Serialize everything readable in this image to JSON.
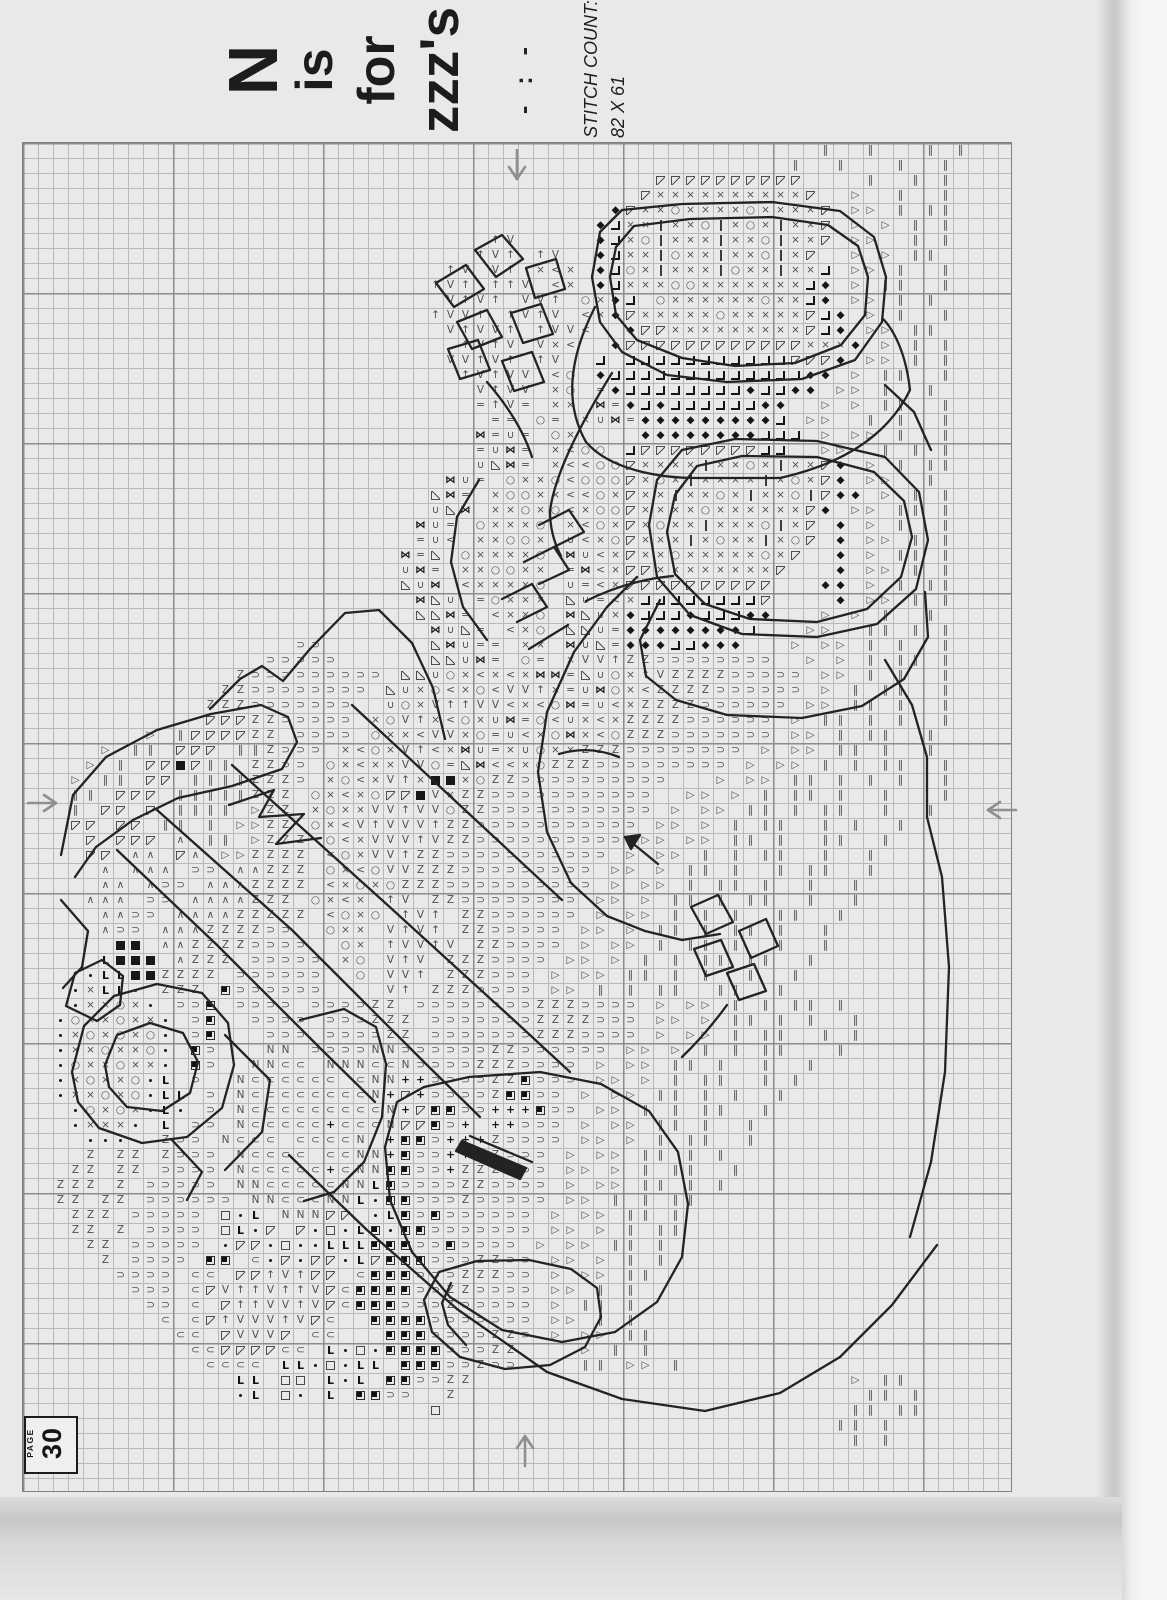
{
  "header": {
    "title_lines": [
      "N",
      "is",
      "for",
      "zzz's"
    ],
    "divider": "- : -",
    "stitch_count_label": "STITCH COUNT:",
    "stitch_count_value": "82 X 61"
  },
  "page_badge": {
    "label": "PAGE",
    "number": "30"
  },
  "grid": {
    "cols": 66,
    "rows": 90,
    "cell_px": 15,
    "major_every": 10
  },
  "arrows": [
    "center-arrow-top-down",
    "center-arrow-left-right",
    "center-arrow-right-left",
    "center-arrow-bottom-up"
  ],
  "colors": {
    "paper": "#e9e9e7",
    "grid_minor": "#b9b9b7",
    "grid_major": "#8c8c8a",
    "symbol": "#4e4e4c",
    "symbol_dark": "#161616",
    "backstitch": "#232321",
    "arrow": "#8f8f8d"
  },
  "legend": {
    "glyphs": {
      "x": "×",
      "o": "○",
      "d": "◆",
      "t": "▷",
      "I": "‖",
      "z": "Z",
      "D": "⊃",
      "A": "∧",
      "^": "↑",
      "V": "V",
      "M": "⋈",
      "U": "∪",
      "<": "<",
      "L": "◁",
      "=": "=",
      "C": "⊂",
      "N": "N",
      "G": "L",
      "+": "+"
    },
    "classes": {
      "x": "g",
      "o": "g",
      "t": "g",
      "I": "g",
      "z": "g",
      "D": "g",
      "A": "g",
      "^": "g",
      "V": "g",
      "U": "g",
      "<": "g",
      "L": "g",
      "=": "g",
      "C": "g",
      "N": "g",
      "d": "k",
      "M": "k",
      "+": "k",
      "G": "kb",
      "B": "B",
      "Q": "Q",
      "q": "q",
      ".": "dot",
      "|": "bar",
      "v": "v",
      "a": "a",
      "j": "j"
    },
    "meaning": {
      "x": "cross stitch ×",
      "o": "circle stitch",
      "d": "filled diamond",
      "t": "open right triangle",
      "I": "double bar",
      "z": "letter Z stitch",
      "D": "open U rotated",
      "A": "caret",
      "^": "up arrow",
      "V": "letter V",
      "M": "bowtie",
      "U": "cup",
      "<": "less-than",
      "L": "open left triangle",
      "=": "equals",
      "C": "open C",
      "N": "letter N",
      "G": "bold L",
      "+": "plus",
      "B": "solid square",
      "Q": "square with corner dot",
      "q": "open square",
      ".": "small dot",
      "|": "thin bar",
      "v": "upper-left half square",
      "a": "lower-left half square",
      "j": "corner bracket"
    }
  },
  "grid_rows": [
    "                                                     I  I   I I",
    "                                                   I  I   I  I",
    "                                          vvvvvvvvvv    I  I I",
    "                                         vxxxxxxxxxxv  t  I  I",
    "                                       dvxxoxxxxoxxxxv tt I II",
    "                                      djxx|xxo|xox|xxv t t I I",
    "                               ^V     djxo|xxx|xxo|xxv tt  I I",
    "                              ^V^ ^V  djxx|oxx|xxo|xv  t t II ",
    "                            ^V V^ x<x djox|xxx|oxx|xxj tt I  I",
    "                           ^V^ ^^V <x djxxxooxxxxxxxjd t II  I",
    "                            V^V^ VV^ oxdj oxxxxxxoxxjd tt I I ",
    "                           ^VV^ ^V^V <xdvxxxxxoxxxxxvjd t I  I",
    "                            V^VV^ ^VV<  dvvxxxxxxxxxvjd tt II ",
    "                             ^V^V Vx<  dvvvvvvvvvvvvxxxd t I I",
    "                            VV^V^ ^V  j jjjjjjjjjjjvvvd tt I I",
    "                             ^V^VV <o djjjjjjjjjjjjjdd t II  I",
    "                              V^VV xo =djjjjjjjjdjjdd tt I  I ",
    "                              =^V= xx M=djdjjjjjjdd  t t II  I",
    "                               == o= xUM=dddddddddj tt  I I  I",
    "                              M=U= ox    ddddddddjjj t tt I  I",
    "                              =UM= x<oo jvvvvvvvvjj  tt  I I I",
    "                              UaM= x<<oovxxxx|xxox|xxvd t I II",
    "                            MU= oxxo<ooovxox|xxxx|xoxvd tt  I ",
    "                           aM= xooxx<<oxvxx|xxox|xxo|vdd t I I",
    "                           UaM xxoxo<xoovxxxxoxxxxxxvd tt II I",
    "                          MU= oxxxo x<oxvxoxx|xxxo|xv d t I  I",
    "                          =U< xxoox U<xovxxx|xoxx|xov d tt I I",
    "                         M=a oxxxxo MU<xvxxoxxxxxoxv  d t II I",
    "                         UM= xxooxx =M<xvvxxxxxxxxv   d tt I I",
    "                         aUM <xxxxo U=<xvvvvvvvvvv   dd t I II",
    "                          MaU =oxxx aU=<xjjjjjjjjv    d tt I I",
    "                          aaM= <xxo MaUxdjjjdjjjdd   t t I  I ",
    "                           MUa= <xo aaU=ddddddddj   tt  II I I",
    "                  DD       aMU== xx MUa=dddjjddd   t tt I I  I",
    "                DDDDD      aaUM= o= xVV^zzDDDDDDDD  t t I II I",
    "              zDDDDDDDDD aaUox<x<xMM=aUox^VzzzzDDDDD tt I I  I",
    "             zzDDDDDDDD aUxo<xo<VV^x=UMox<zzzzDDDDDD t I II  I",
    "            zzzDDDDDDD  UoxV^^VV<x<oM=U<xzzzzDDDDDD tt II I  I",
    "            vvvzzDDDDD xoV^x<oxUM=o<Ux<xzzzzDDDDDD t II I I  I",
    "        t Ivvvvzz DDDD oxx<VVxo=U<xoMx<ozzzDDDDDDD tt I II  I ",
    "     t II vvv IIzDDD x<oxV^<xMU=xUoxxzzzDDDDDDDD t tt II I  I ",
    "    t I vvBvII zzDD ox<xxVVo=aM<<xozzzDDDDDDDDD t tt I I II  I",
    "   t II vv IIIIzzzD xo<xV^xBBxozzDDDDDDDDDD   t tt II I I I  I",
    "   II vvv IIIIIzzz ox<xovvBVxzzDDDDDDDDDDD  tt t I II I  I   I",
    "   I vv v IIII tzz xoxxVV^VVozzDDDDDDDDDDD t tt II I II  I  I ",
    "   vv vv II I ttzz ox<V^VVV^zzDDDDDDDDDDD tt t I II  I I  I   ",
    "    v vvv A II tzzz o<xVVV^VzzDDDDDDDDDD tt tt II I  II  I    ",
    "    vv AA vA ttzzzz <oxVV^zzDDDDDDDDDDD t tt I I II  I  I     ",
    "     A AAA DD AAzzz ox<oVVzzzDDDDDDDDD tt t II I  I II  I     ",
    "     AA ADD AAAzzzz <xoxozzzDDDDDDDDDD t tt I II I  I  I      ",
    "    AAA DD AAAAzzz ox<x ^V zzDDDDDDDD tt t II I II  I  I      ",
    "     AADD AAAAzzzzz <oxo ^V^ zzDDDDDD t tt I I I  II  I       ",
    "     ADD AAAzzzzDD  oxx V^V^ zzDDDDD tt t II I II I  I        ",
    "      BB AAzzzzDDDD  ox ^VV^V zzDDDD t tt I II I  I  I        ",
    "     GBBB Azzz DDDDD xo V^V zzzDDDD tt t I I II II  I         ",
    "    .GGBBzzzz DDDDDD  o VV^ zzzDDD t tt II I I  I  I          ",
    "   .xGG. zzz QDDDDDD    V^ zzzDDDD tt I I II  II  I           ",
    "   .xxox. DDQ DDDD DDDDzz DDDDDDDDzzzDDDD t tt I I II I       ",
    "  .oxxoxx. DQ  DDDD DDDzzz DDDDDDDzzzzDDD tt t II I I  I      ",
    "  .xoxoxo. DQ   DDD DDDDzz DDDDDDDzzzDDDD t tt I II  I I      ",
    "  .xxoxxo. QD   NN DDDDNNDDDDDDzzDDDDDD tt t I I II   I       ",
    "  .oxxoxx. QD  NNCC NNNCCNDDDDzzzDDDD t tt II I  I  I         ",
    "  .xoxxo.G D  NCCCCCC CNN++DDDDzzQDDD tt t I II  I I          ",
    "  .xxoxo.GG D NCCCCCCCCN+v+DDDDzQQDD t tt II I I  I           ",
    "   .oxox.G. D NCCCCCCCCCN+vQQDD+++QDD tt I I II  I            ",
    "   .xxx. G DD NCCCCC+CCCNvvQD+ ++DDD t tt II I  I             ",
    "    ...  zDD NCCC CCCCN +QQD+++zDDDD tt t I II  I             ",
    "    z zz zDDD NCCCC CCNN+QDD++zzDDD t tt II I I               ",
    "   zz zz DDDD NCCCCC+CNNQQDD+zzzDDD tt t I II  I              ",
    "  zzz z DDDDD NNCCCCCNNGQDDDDzzDDDD t tt II I I               ",
    "  zz zz DDDDDD NNCCCNNG.QQDDDzDDDDD tt I I II                 ",
    "   zzz DDDDD q.G NNNvv .GQDQDDDDDD t tt II I                  ",
    "   zz z DDDD qG.v v.q.GQ.QQDDDDDDD tt t I II                  ",
    "    zz DDDDD .vv.q..GGGQQQDDQDDDD t tt II I                   ",
    "     z DDDD QQ C.v.vv.GvQQQDDDzzDD tt t I I                   ",
    "      DDDD CC vv^V^vv CQQQDDDzzzDD t tt II                    ",
    "       DDD CvV^^V^^VvCQQQQDDzzDDDD tt I I                     ",
    "        DD C v^^VV^VvCQQQDDDzDDDDD t II I                     ",
    "         C Cv^VVV^VvC  QQQQDDDDDDD tt I I                     ",
    "          CC vVVVv CC   QQQDDDDzzD t tt II                    ",
    "           CCvvvvCC G.q.QQQQDDDzz    t I I                    ",
    "            CCCC GG.q.GG QQQDDzDD    II tt I                  ",
    "              GG qq G.G QQDDzz                         t II   ",
    "              .G q. G QQDD  z                           II I  ",
    "                           q                           II II  ",
    "                                                      II I    ",
    "                                                       I I    ",
    "",
    "",
    ""
  ]
}
